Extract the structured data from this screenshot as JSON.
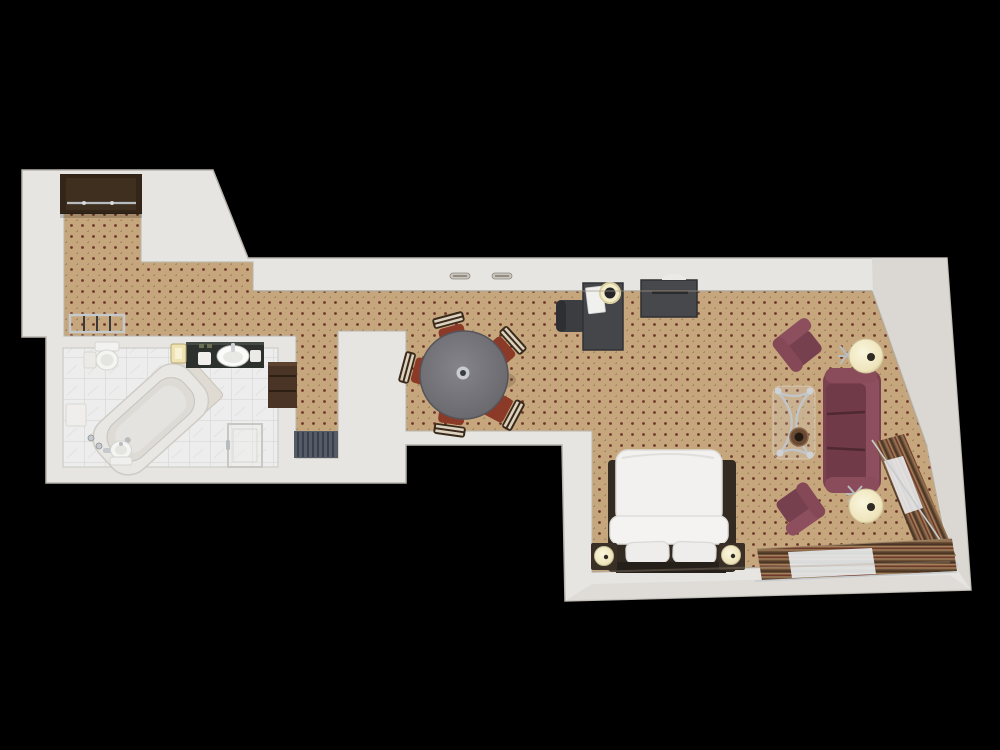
{
  "scene": {
    "title": "3D top-down floor plan render of a hotel suite",
    "background": "#000000",
    "rooms": [
      "entry-hall",
      "closet",
      "bathroom",
      "corridor",
      "dining-area",
      "work-area",
      "bedroom-living-area"
    ],
    "furniture": [
      "wardrobe-closet",
      "luggage-rack",
      "vanity-counter",
      "vanity-sink",
      "toilet",
      "bidet",
      "corner-bathtub",
      "shower-glass",
      "wall-shelf",
      "radiator",
      "dining-table",
      "dining-chairs-x5",
      "desk",
      "desk-chair",
      "desk-lamp",
      "dresser",
      "wall-sconces",
      "double-bed",
      "nightstand-left",
      "nightstand-right",
      "sofa",
      "armchair-top",
      "armchair-bottom",
      "floor-lamp-top",
      "floor-lamp-bottom",
      "glass-coffee-table",
      "window-drapes-right",
      "window-drapes-bottom"
    ]
  },
  "palette": {
    "black": "#000000",
    "wall": "#e7e5e1",
    "wallEdge": "#c9c5bf",
    "carpet": "#c6a77d",
    "carpetDot": "#6e3529",
    "carpetDot2": "#8a6848",
    "tile": "#ecedec",
    "grout": "#d6d7d5",
    "marble": "#e2e3e1",
    "woodDark": "#332618",
    "woodShelf": "#4a3425",
    "counter": "#2c312d",
    "sofa": "#7c4150",
    "sofaLight": "#8d4f5e",
    "sofaDeep": "#65333f",
    "chairRed": "#8c3a28",
    "chairStripeDark": "#3a2a1c",
    "chairStripeLight": "#ddd2bd",
    "tableGray": "#77767b",
    "deskGray": "#45464a",
    "chairGray": "#3c3d40",
    "duvet": "#f2f1ef",
    "pillow": "#eeedeb",
    "headboard": "#26201a",
    "cream": "#f3ecca",
    "chrome": "#c2c5c8",
    "drapeBase": "#6b4e36",
    "radiator": "#555c68",
    "glow": "#f0e3b2"
  }
}
